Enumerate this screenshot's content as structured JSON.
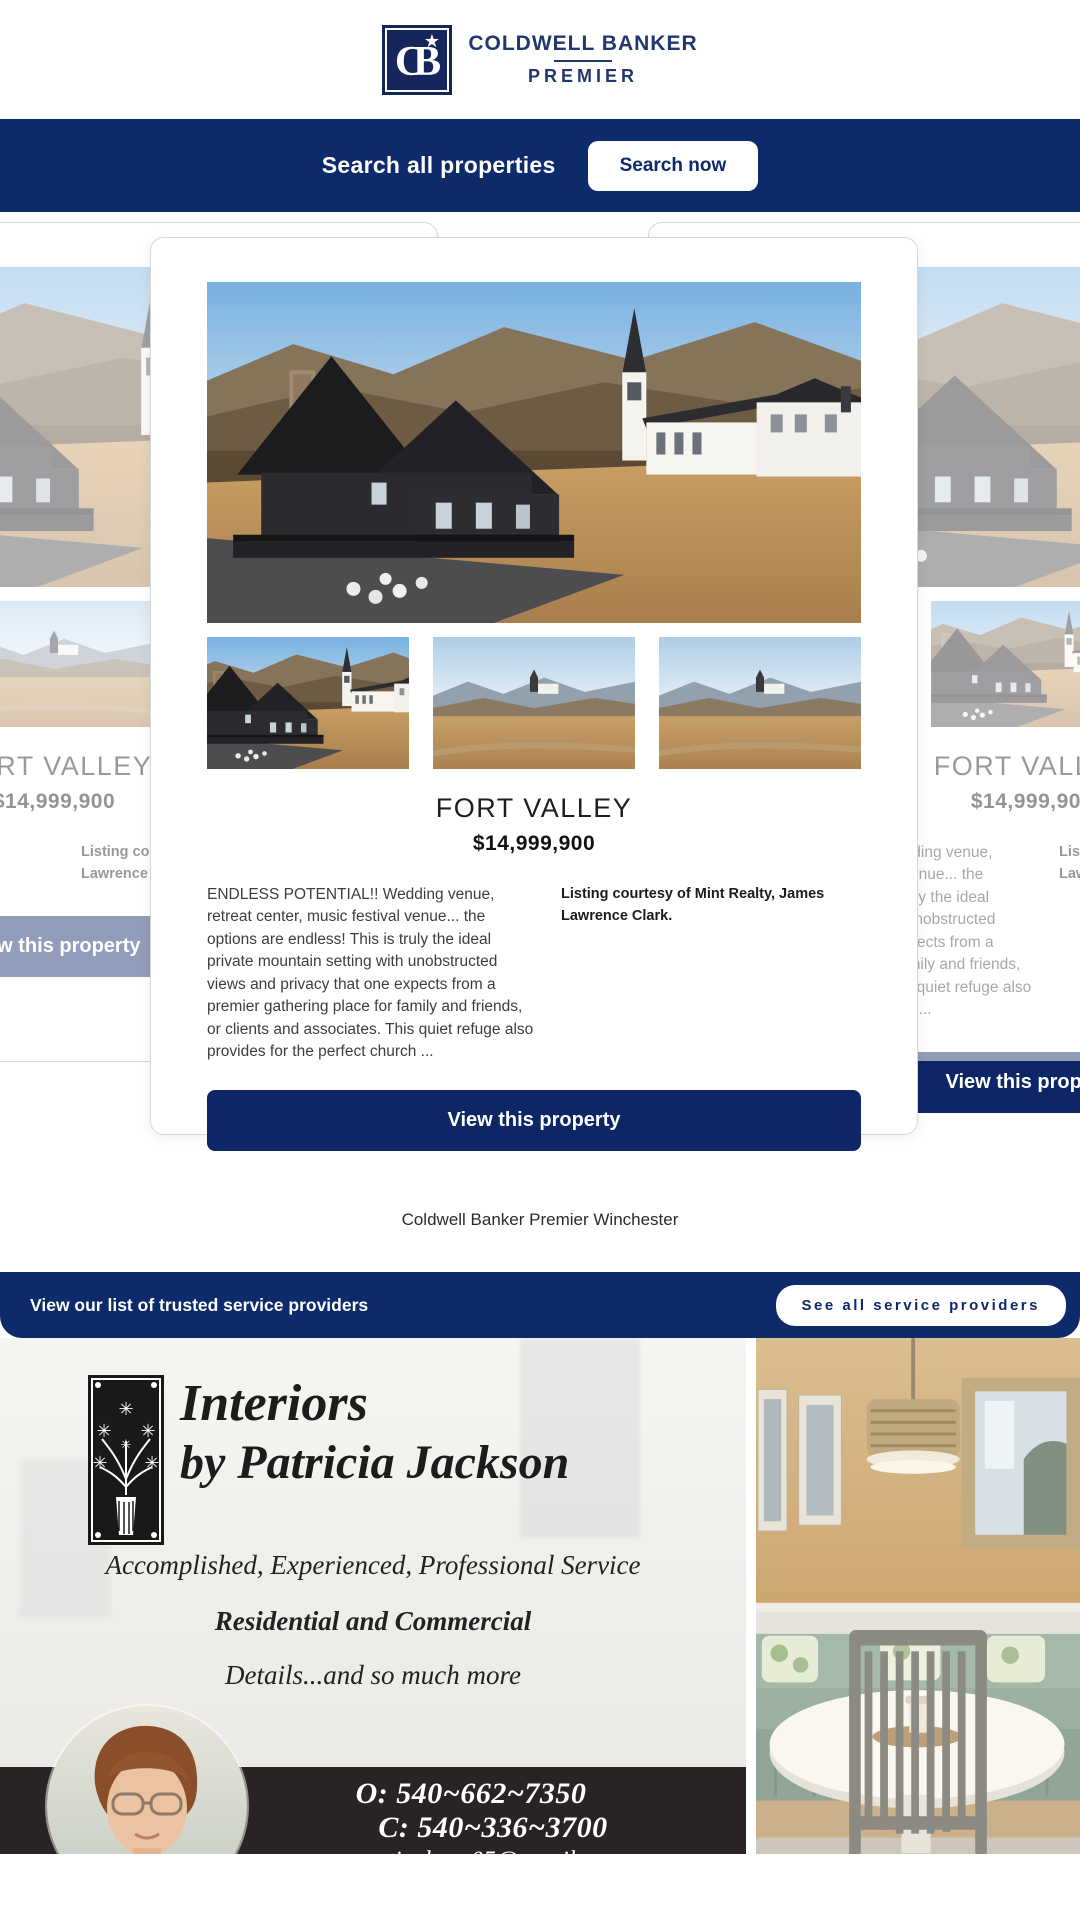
{
  "brand": {
    "monogram": "CB",
    "star": "★",
    "name_top": "COLDWELL BANKER",
    "name_bottom": "PREMIER"
  },
  "search": {
    "label": "Search all properties",
    "button_label": "Search now"
  },
  "listing": {
    "title": "FORT VALLEY",
    "price": "$14,999,900",
    "description": "ENDLESS POTENTIAL!! Wedding venue, retreat center, music festival venue... the options are endless! This is truly the ideal private mountain setting with unobstructed views and privacy that one expects from a premier gathering place for family and friends, or clients and associates. This quiet refuge also provides for the perfect church ...",
    "courtesy": "Listing courtesy of Mint Realty, James Lawrence Clark.",
    "view_button_label": "View this property"
  },
  "office": {
    "name": "Coldwell Banker Premier Winchester"
  },
  "service_bar": {
    "label": "View our list of trusted service providers",
    "button_label": "See all service providers"
  },
  "ad": {
    "headline_line1": "Interiors",
    "headline_line2": "by Patricia Jackson",
    "tagline1": "Accomplished, Experienced, Professional Service",
    "tagline2": "Residential and Commercial",
    "tagline3": "Details...and so much more",
    "hours": "Hours by Appointment",
    "phone_office": "O: 540~662~7350",
    "phone_cell": "C: 540~336~3700",
    "email": "patjackson05@gmail.com"
  },
  "colors": {
    "navy_bar": "#0d2a6b",
    "button_navy": "#0d2766",
    "brand_navy": "#21386f",
    "contact_bar_dark": "#2a2323",
    "faded_side_button": "#96a2c2"
  }
}
